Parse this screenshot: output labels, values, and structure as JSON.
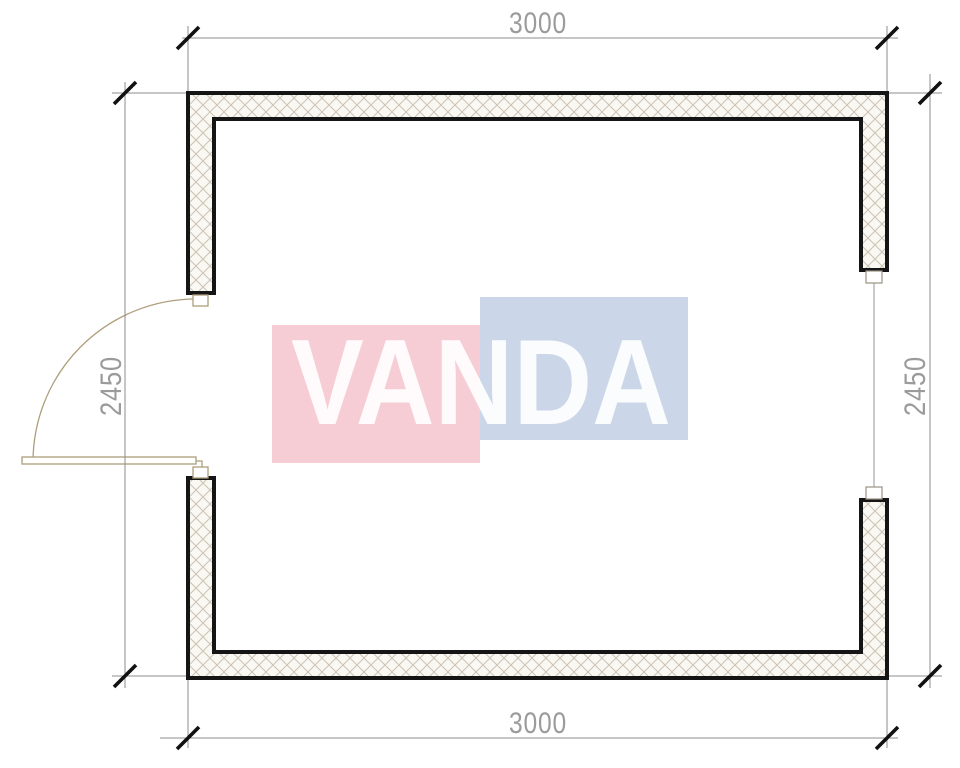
{
  "drawing": {
    "dimensions": {
      "top": "3000",
      "bottom": "3000",
      "left": "2450",
      "right": "2450"
    },
    "watermark": {
      "text": "VANDA",
      "pink_color": "#f7cdd5",
      "blue_color": "#cbd7e8",
      "text_color": "#ffffff"
    },
    "colors": {
      "wall_outline": "#151515",
      "wall_hatch_line": "#cbc3b3",
      "wall_hatch_bg": "#faf8f3",
      "dimension_line": "#8d8d8d",
      "dimension_text": "#9b9b9b",
      "door": "#ae9f7c",
      "window": "#9a9284"
    },
    "elements": {
      "door": "hinged-door-left-wall",
      "window": "window-right-wall"
    }
  }
}
